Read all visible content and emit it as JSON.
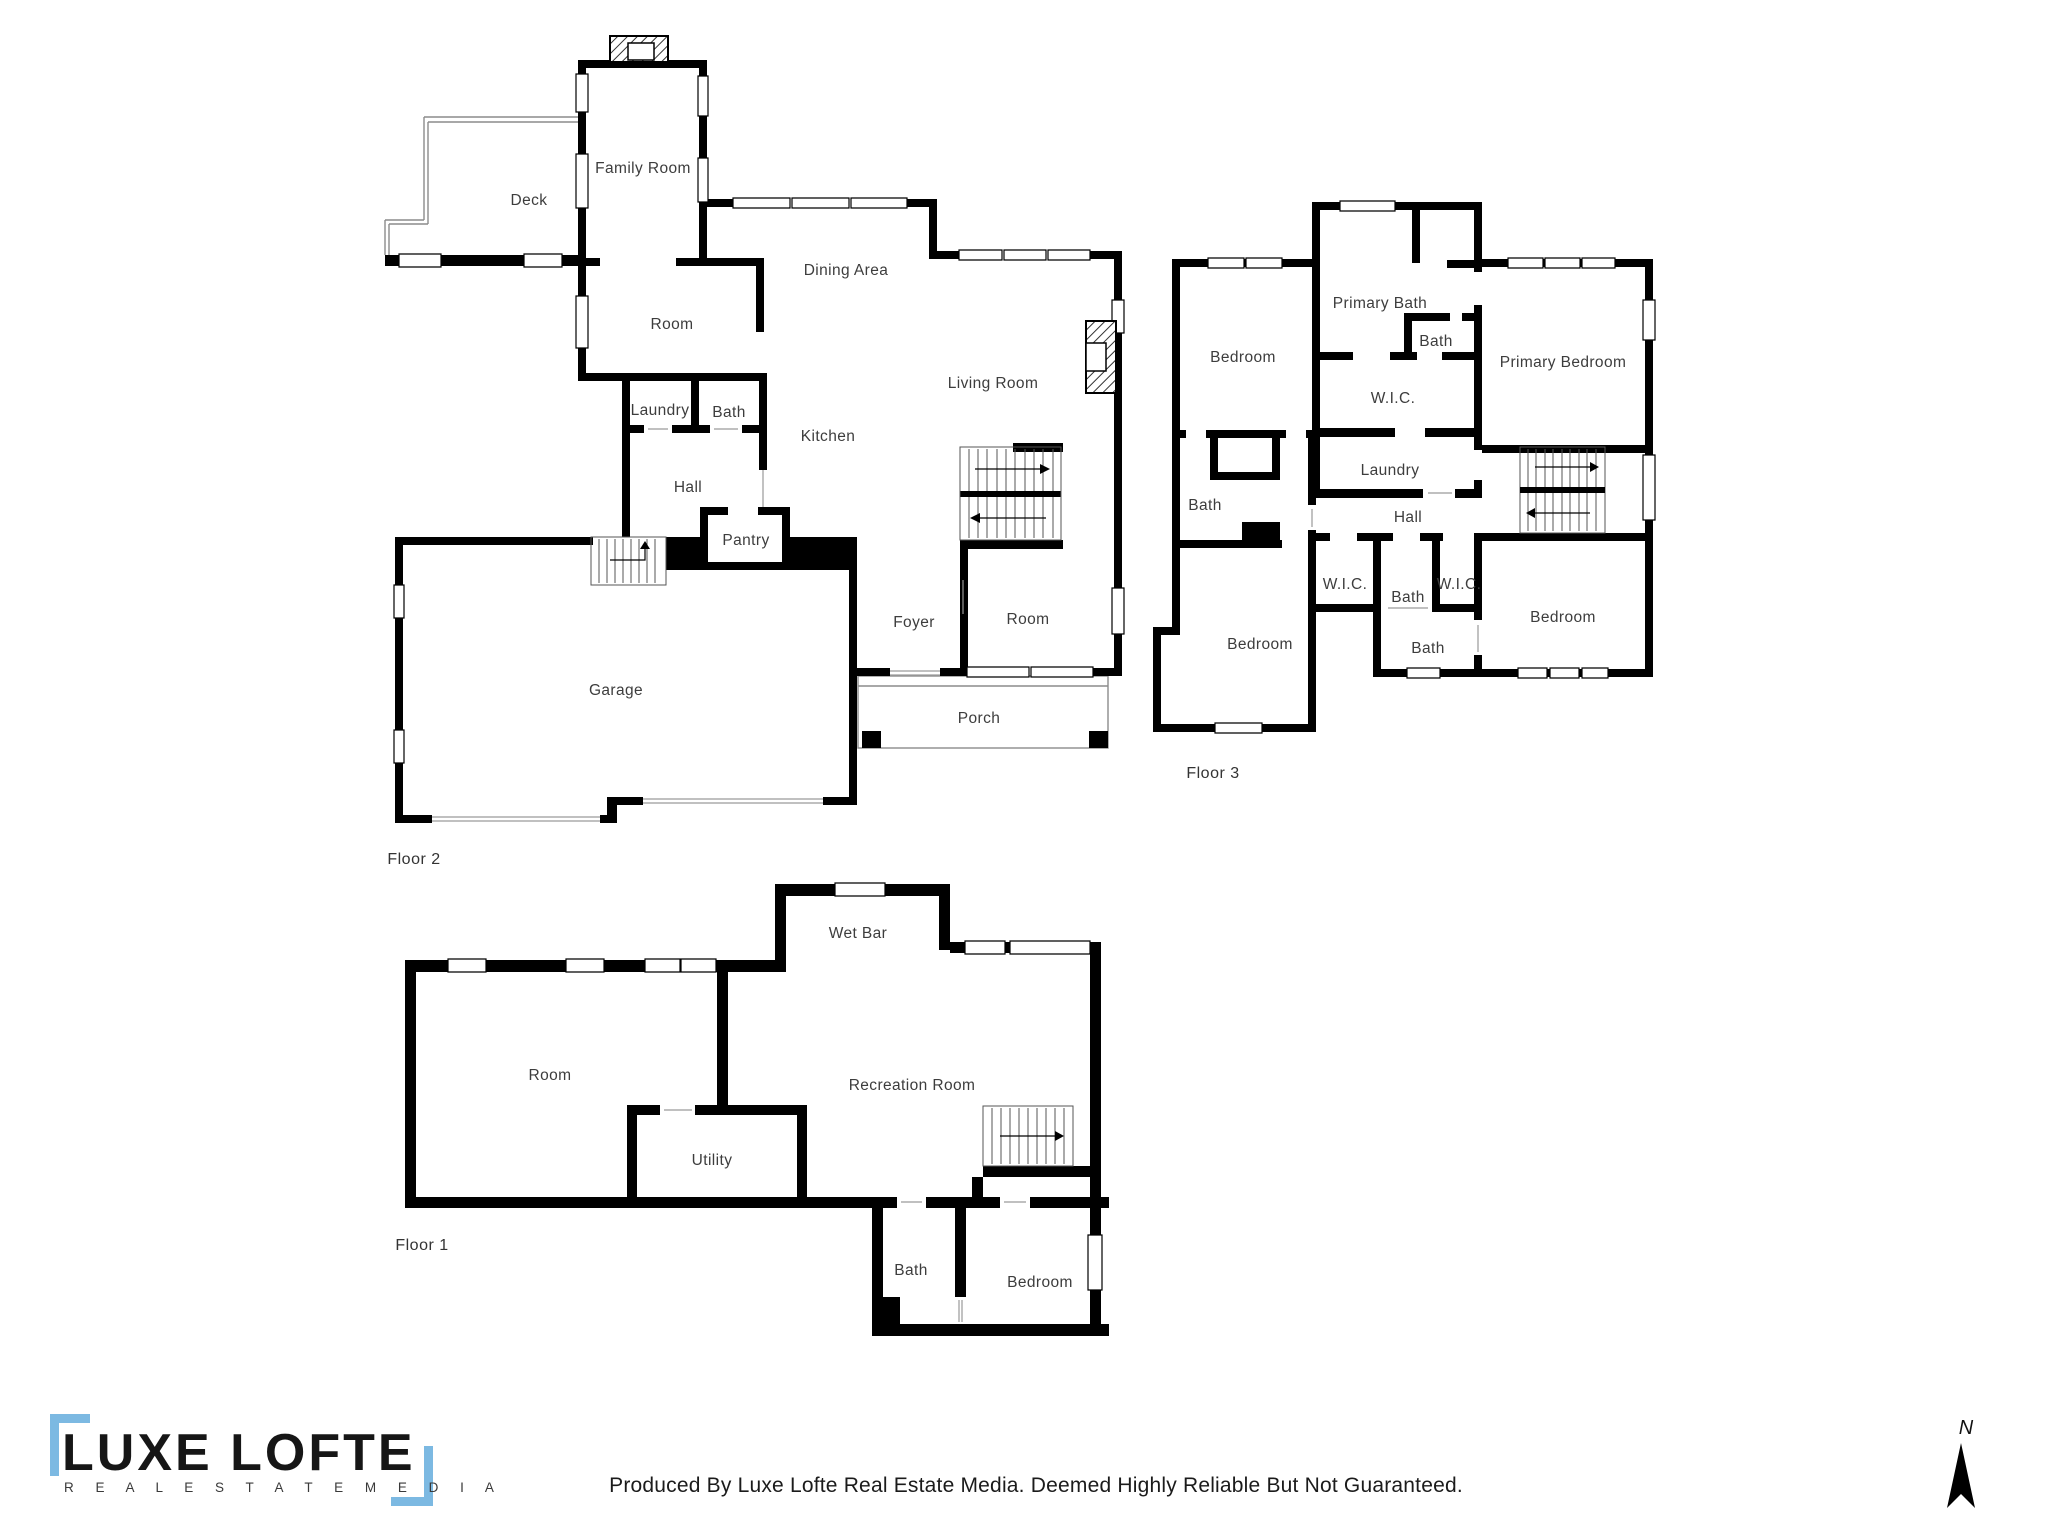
{
  "floors": [
    {
      "label": "Floor 2",
      "rooms": {
        "deck": "Deck",
        "family": "Family Room",
        "dining": "Dining Area",
        "room_upper": "Room",
        "living": "Living Room",
        "laundry": "Laundry",
        "bath": "Bath",
        "kitchen": "Kitchen",
        "hall": "Hall",
        "pantry": "Pantry",
        "garage": "Garage",
        "foyer": "Foyer",
        "room_lower": "Room",
        "porch": "Porch"
      }
    },
    {
      "label": "Floor 3",
      "rooms": {
        "bedroom_tl": "Bedroom",
        "primary_bath": "Primary Bath",
        "bath_small": "Bath",
        "primary_bedroom": "Primary Bedroom",
        "wic_main": "W.I.C.",
        "laundry": "Laundry",
        "bath_left": "Bath",
        "hall": "Hall",
        "wic_left": "W.I.C.",
        "bath_mid": "Bath",
        "wic_right": "W.I.C.",
        "bedroom_bl": "Bedroom",
        "bath_lower": "Bath",
        "bedroom_br": "Bedroom"
      }
    },
    {
      "label": "Floor 1",
      "rooms": {
        "wet_bar": "Wet Bar",
        "room": "Room",
        "recreation": "Recreation Room",
        "utility": "Utility",
        "bath": "Bath",
        "bedroom": "Bedroom"
      }
    }
  ],
  "branding": {
    "name": "LUXE LOFTE",
    "tagline": "R E A L   E S T A T E   M E D I A"
  },
  "footer": {
    "disclaimer": "Produced By Luxe Lofte Real Estate Media. Deemed Highly Reliable But Not Guaranteed."
  },
  "compass": {
    "north": "N"
  },
  "colors": {
    "wall": "#000000",
    "accent_blue": "#7cb9e2",
    "background": "#ffffff",
    "label_text": "#3d3d3d"
  }
}
